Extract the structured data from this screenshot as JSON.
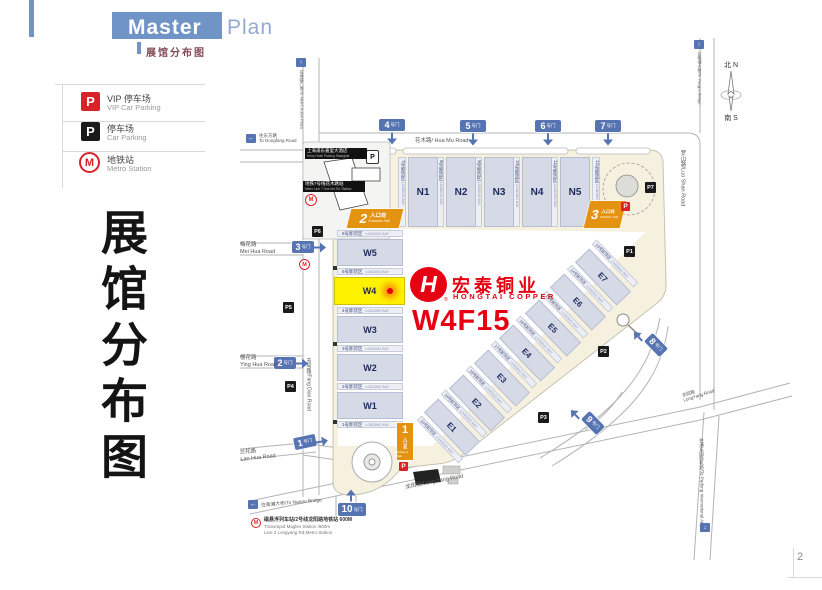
{
  "page": {
    "corner_number": "2"
  },
  "header": {
    "title_part1": "Master",
    "title_part2": "Plan",
    "subtitle": "展馆分布图"
  },
  "legend": {
    "vip": {
      "icon": "P",
      "zh": "VIP 停车场",
      "en": "VIP Car Parking"
    },
    "car": {
      "icon": "P",
      "zh": "停车场",
      "en": "Car Parking"
    },
    "metro": {
      "icon": "M",
      "zh": "地铁站",
      "en": "Metro Station"
    }
  },
  "side_title": "展馆分布图",
  "compass": {
    "north": "北 N",
    "south": "南 S"
  },
  "exhibitor": {
    "logo_letter": "H",
    "reg": "®",
    "name_zh": "宏泰铜业",
    "name_en": "HONGTAI COPPER",
    "booth": "W4F15"
  },
  "halls": {
    "north": [
      "N1",
      "N2",
      "N3",
      "N4",
      "N5"
    ],
    "west": [
      "W5",
      "W4",
      "W3",
      "W2",
      "W1"
    ],
    "east": [
      "E7",
      "E6",
      "E5",
      "E4",
      "E3",
      "E2",
      "E1"
    ]
  },
  "bays": {
    "en": "LOADING BAY",
    "north": [
      "7号卸货区",
      "8号卸货区",
      "9号卸货区",
      "10号卸货区",
      "11号卸货区",
      "12号卸货区"
    ],
    "west": [
      "6号卸货区",
      "5号卸货区",
      "4号卸货区",
      "3号卸货区",
      "2号卸货区",
      "1号卸货区"
    ],
    "east": [
      "13号卸货区",
      "14号卸货区",
      "15号卸货区",
      "16号卸货区",
      "17号卸货区",
      "18号卸货区",
      "19号卸货区",
      "20号卸货区"
    ]
  },
  "gates": {
    "suffix": "号门",
    "g1": "1",
    "g2": "2",
    "g3": "3",
    "g4": "4",
    "g5": "5",
    "g6": "6",
    "g7": "7",
    "g8": "8",
    "g9": "9",
    "g10": "10"
  },
  "entrances": {
    "zh": "入口处",
    "en": "Entrance Hall",
    "e1": "1",
    "e2": "2",
    "e3": "3"
  },
  "parking": {
    "p1": "P1",
    "p2": "P2",
    "p3": "P3",
    "p4": "P4",
    "p5": "P5",
    "p6": "P6",
    "p7": "P7",
    "vip": "P",
    "hotel": "P"
  },
  "roads": {
    "hua_mu": "花木路/ Hua Mu Road",
    "luo_shan": "罗山路/Luo Shan Road",
    "mei_hua_zh": "梅花路",
    "mei_hua_en": "Mei Hua Road",
    "ying_hua_zh": "樱花路",
    "ying_hua_en": "Ying Hua Road",
    "lan_hua_zh": "兰花路",
    "lan_hua_en": "Lan Hua Road",
    "fang_dian": "芳甸路/Fang Dian Road",
    "long_yang_1": "龙阳路/Long Yang Road",
    "long_yang_2_zh": "龙阳路",
    "long_yang_2_en": "LongYang Road",
    "airport": "往浦东国际机场/To Pudong International Airport"
  },
  "signs": {
    "metro_plaza": "往地铁广场/To Metro Kunxi Plaza",
    "yangpu": "往杨浦大桥/To Yangpu Bridge",
    "dongfang_zh": "往东方路",
    "dongfang_en": "To Dongfang Road",
    "nanpu": "往南浦大桥/To Nanpu Bridge"
  },
  "buildings": {
    "kerry_zh": "上海浦东嘉里大酒店",
    "kerry_en": "Kerry Hotel Pudong Shanghai",
    "metro7_zh": "地铁7号线花木路站",
    "metro7_en": "Metro Line 7 Hua Mu Rd. Station"
  },
  "metro_note": {
    "zh": "磁悬浮列车站/2号线龙阳路地铁站 600M",
    "en1": "Transrapid Maglev Station /600m",
    "en2": "Line 2 Longyang Rd.Metro Station"
  }
}
